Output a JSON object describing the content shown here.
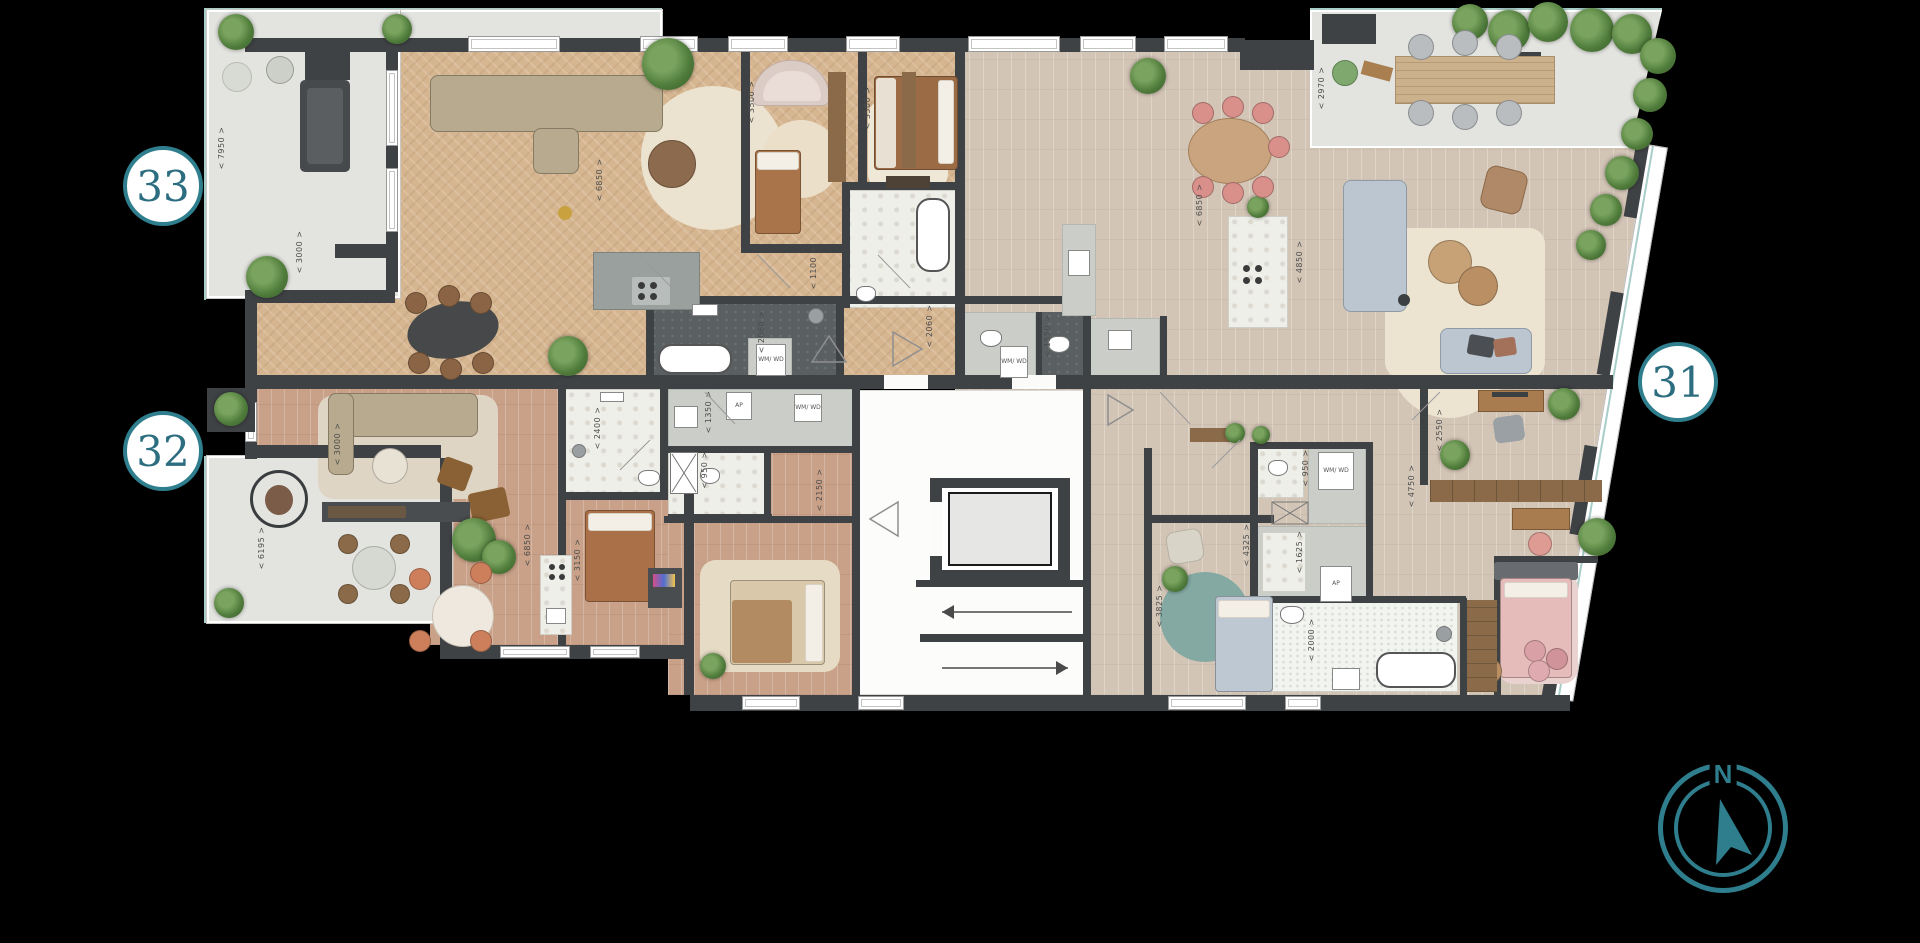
{
  "canvas": {
    "width": 1920,
    "height": 943,
    "background": "#000000"
  },
  "units": [
    {
      "number": "33",
      "x": 163,
      "y": 186
    },
    {
      "number": "32",
      "x": 163,
      "y": 451
    },
    {
      "number": "31",
      "x": 1678,
      "y": 382
    }
  ],
  "compass": {
    "label": "N"
  },
  "colors": {
    "accent_teal": "#2f7e8d",
    "wall_dark": "#3f4245",
    "terrace_gray": "#e3e4df",
    "wood_warm": "#d6b691",
    "wood_light": "#d3c5b6",
    "wood_rose": "#c9a188",
    "glass_teal": "#a8cdc9"
  },
  "dimension_labels": [
    {
      "text": "7950",
      "x": 222,
      "y": 148
    },
    {
      "text": "3000",
      "x": 300,
      "y": 252
    },
    {
      "text": "6850",
      "x": 600,
      "y": 180
    },
    {
      "text": "3500",
      "x": 752,
      "y": 102
    },
    {
      "text": "3500",
      "x": 868,
      "y": 108
    },
    {
      "text": "1100",
      "x": 814,
      "y": 268
    },
    {
      "text": "2060",
      "x": 762,
      "y": 332
    },
    {
      "text": "2060",
      "x": 930,
      "y": 326
    },
    {
      "text": "1550",
      "x": 1048,
      "y": 336
    },
    {
      "text": "2970",
      "x": 1322,
      "y": 88
    },
    {
      "text": "6850",
      "x": 1200,
      "y": 205
    },
    {
      "text": "4850",
      "x": 1300,
      "y": 262
    },
    {
      "text": "2550",
      "x": 1440,
      "y": 430
    },
    {
      "text": "4750",
      "x": 1412,
      "y": 486
    },
    {
      "text": "6195",
      "x": 262,
      "y": 548
    },
    {
      "text": "3000",
      "x": 338,
      "y": 444
    },
    {
      "text": "2400",
      "x": 598,
      "y": 428
    },
    {
      "text": "1350",
      "x": 709,
      "y": 412
    },
    {
      "text": "950",
      "x": 705,
      "y": 470
    },
    {
      "text": "2150",
      "x": 820,
      "y": 490
    },
    {
      "text": "3150",
      "x": 578,
      "y": 560
    },
    {
      "text": "6850",
      "x": 528,
      "y": 545
    },
    {
      "text": "3825",
      "x": 1160,
      "y": 606
    },
    {
      "text": "4325",
      "x": 1247,
      "y": 545
    },
    {
      "text": "1625",
      "x": 1300,
      "y": 552
    },
    {
      "text": "950",
      "x": 1306,
      "y": 468
    },
    {
      "text": "2000",
      "x": 1312,
      "y": 640
    }
  ],
  "appliance_labels": [
    {
      "text": "WM/ WD",
      "x": 756,
      "y": 344,
      "w": 30,
      "h": 32
    },
    {
      "text": "AP",
      "x": 726,
      "y": 392,
      "w": 26,
      "h": 28
    },
    {
      "text": "WM/ WD",
      "x": 794,
      "y": 394,
      "w": 28,
      "h": 28
    },
    {
      "text": "WM/ WD",
      "x": 1000,
      "y": 346,
      "w": 28,
      "h": 32
    },
    {
      "text": "WM/ WD",
      "x": 1318,
      "y": 452,
      "w": 36,
      "h": 38
    },
    {
      "text": "AP",
      "x": 1320,
      "y": 566,
      "w": 32,
      "h": 36
    }
  ]
}
